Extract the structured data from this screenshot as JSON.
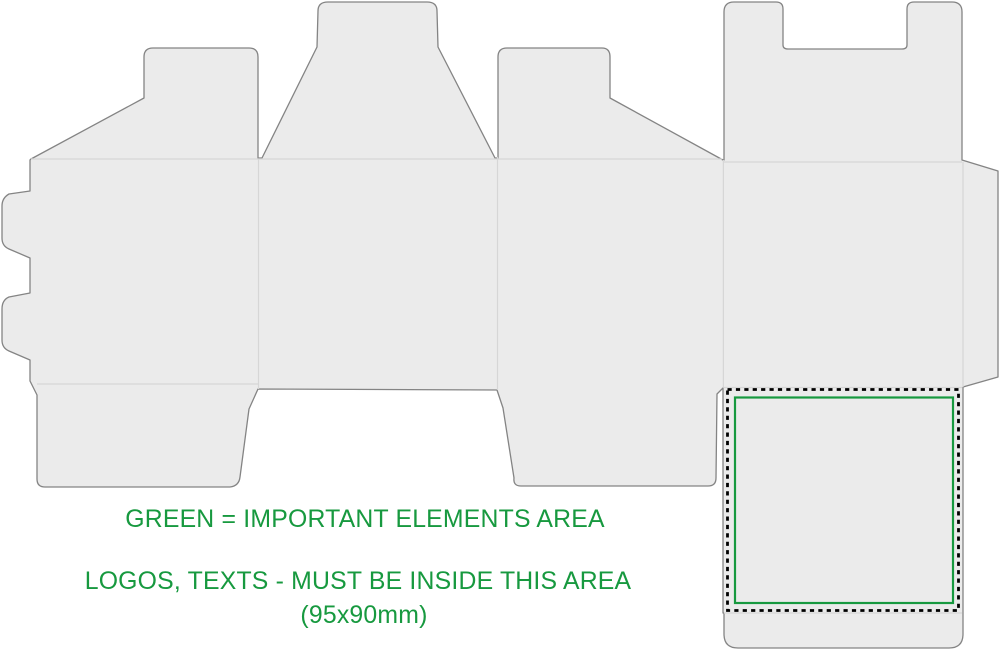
{
  "canvas": {
    "width": 1000,
    "height": 651,
    "background": "#ffffff"
  },
  "caption": {
    "line1": "GREEN = IMPORTANT ELEMENTS AREA",
    "line2": "LOGOS, TEXTS - MUST BE INSIDE THIS AREA",
    "line3": "(95x90mm)"
  },
  "important_area": {
    "width_mm": 95,
    "height_mm": 90,
    "dimensions_label": "(95x90mm)"
  },
  "colors": {
    "page_bg": "#ffffff",
    "panel_fill": "#ebebeb",
    "cut_line": "#848484",
    "fold_line": "#d6d6d6",
    "important_area_green": "#17993f",
    "print_area_dash": "#000000"
  }
}
